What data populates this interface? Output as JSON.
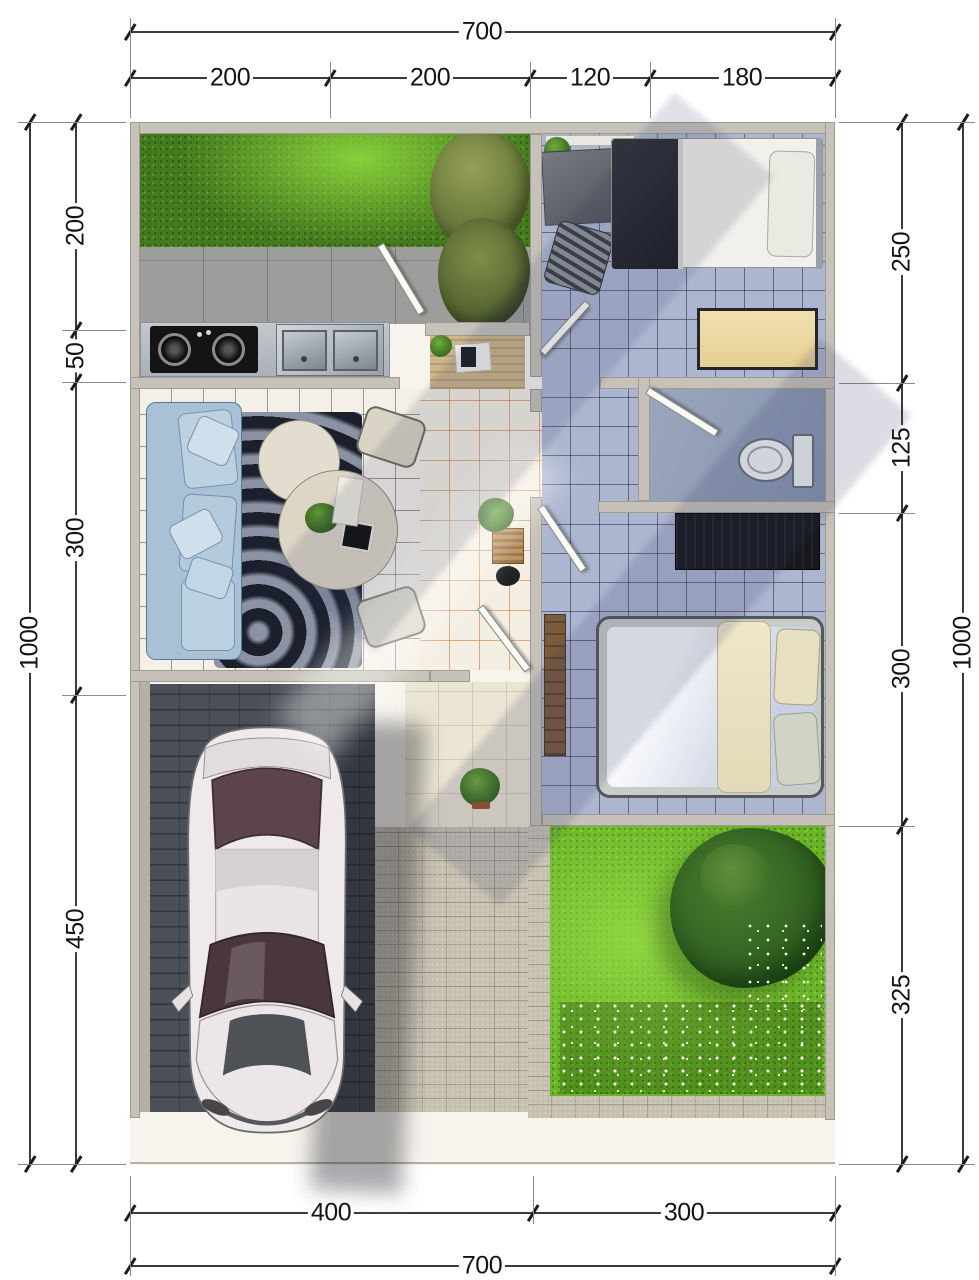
{
  "diagram": {
    "type": "floor-plan",
    "view": "top-down-3d-render",
    "units": "cm"
  },
  "dimensions": {
    "top": {
      "total": "700",
      "segments": [
        "200",
        "200",
        "120",
        "180"
      ]
    },
    "bottom": {
      "total": "700",
      "segments": [
        "400",
        "300"
      ]
    },
    "left": {
      "total": "1000",
      "segments": [
        "200",
        "50",
        "300",
        "450"
      ]
    },
    "right": {
      "total": "1000",
      "segments": [
        "250",
        "125",
        "300",
        "325"
      ]
    }
  },
  "rooms": [
    {
      "name": "service-garden",
      "fill": "#447a1e"
    },
    {
      "name": "kitchen",
      "fill": "#9d9d9b"
    },
    {
      "name": "bedroom-1",
      "fill": "#adb6d0"
    },
    {
      "name": "living-room",
      "fill": "#f4f0e8"
    },
    {
      "name": "hallway",
      "fill": "#f4eee3"
    },
    {
      "name": "bathroom",
      "fill": "#93a0b8"
    },
    {
      "name": "bedroom-2",
      "fill": "#adb6d0"
    },
    {
      "name": "terrace",
      "fill": "#ebe5d3"
    },
    {
      "name": "carport",
      "fill": "#4a4f58"
    },
    {
      "name": "garden",
      "fill": "#6ab428"
    }
  ],
  "palette": {
    "wall": "#c6c2b9",
    "dim_line": "#3b3b3b",
    "grout_orange": "#c47034",
    "sofa": "#a9c1d6",
    "rug": "#394050",
    "wardrobe": "#17181d",
    "car_body": "#efe9ec",
    "car_glass": "#4a363d",
    "light_pavers": "#c6c0b0",
    "terrace": "#ebe5d3"
  }
}
